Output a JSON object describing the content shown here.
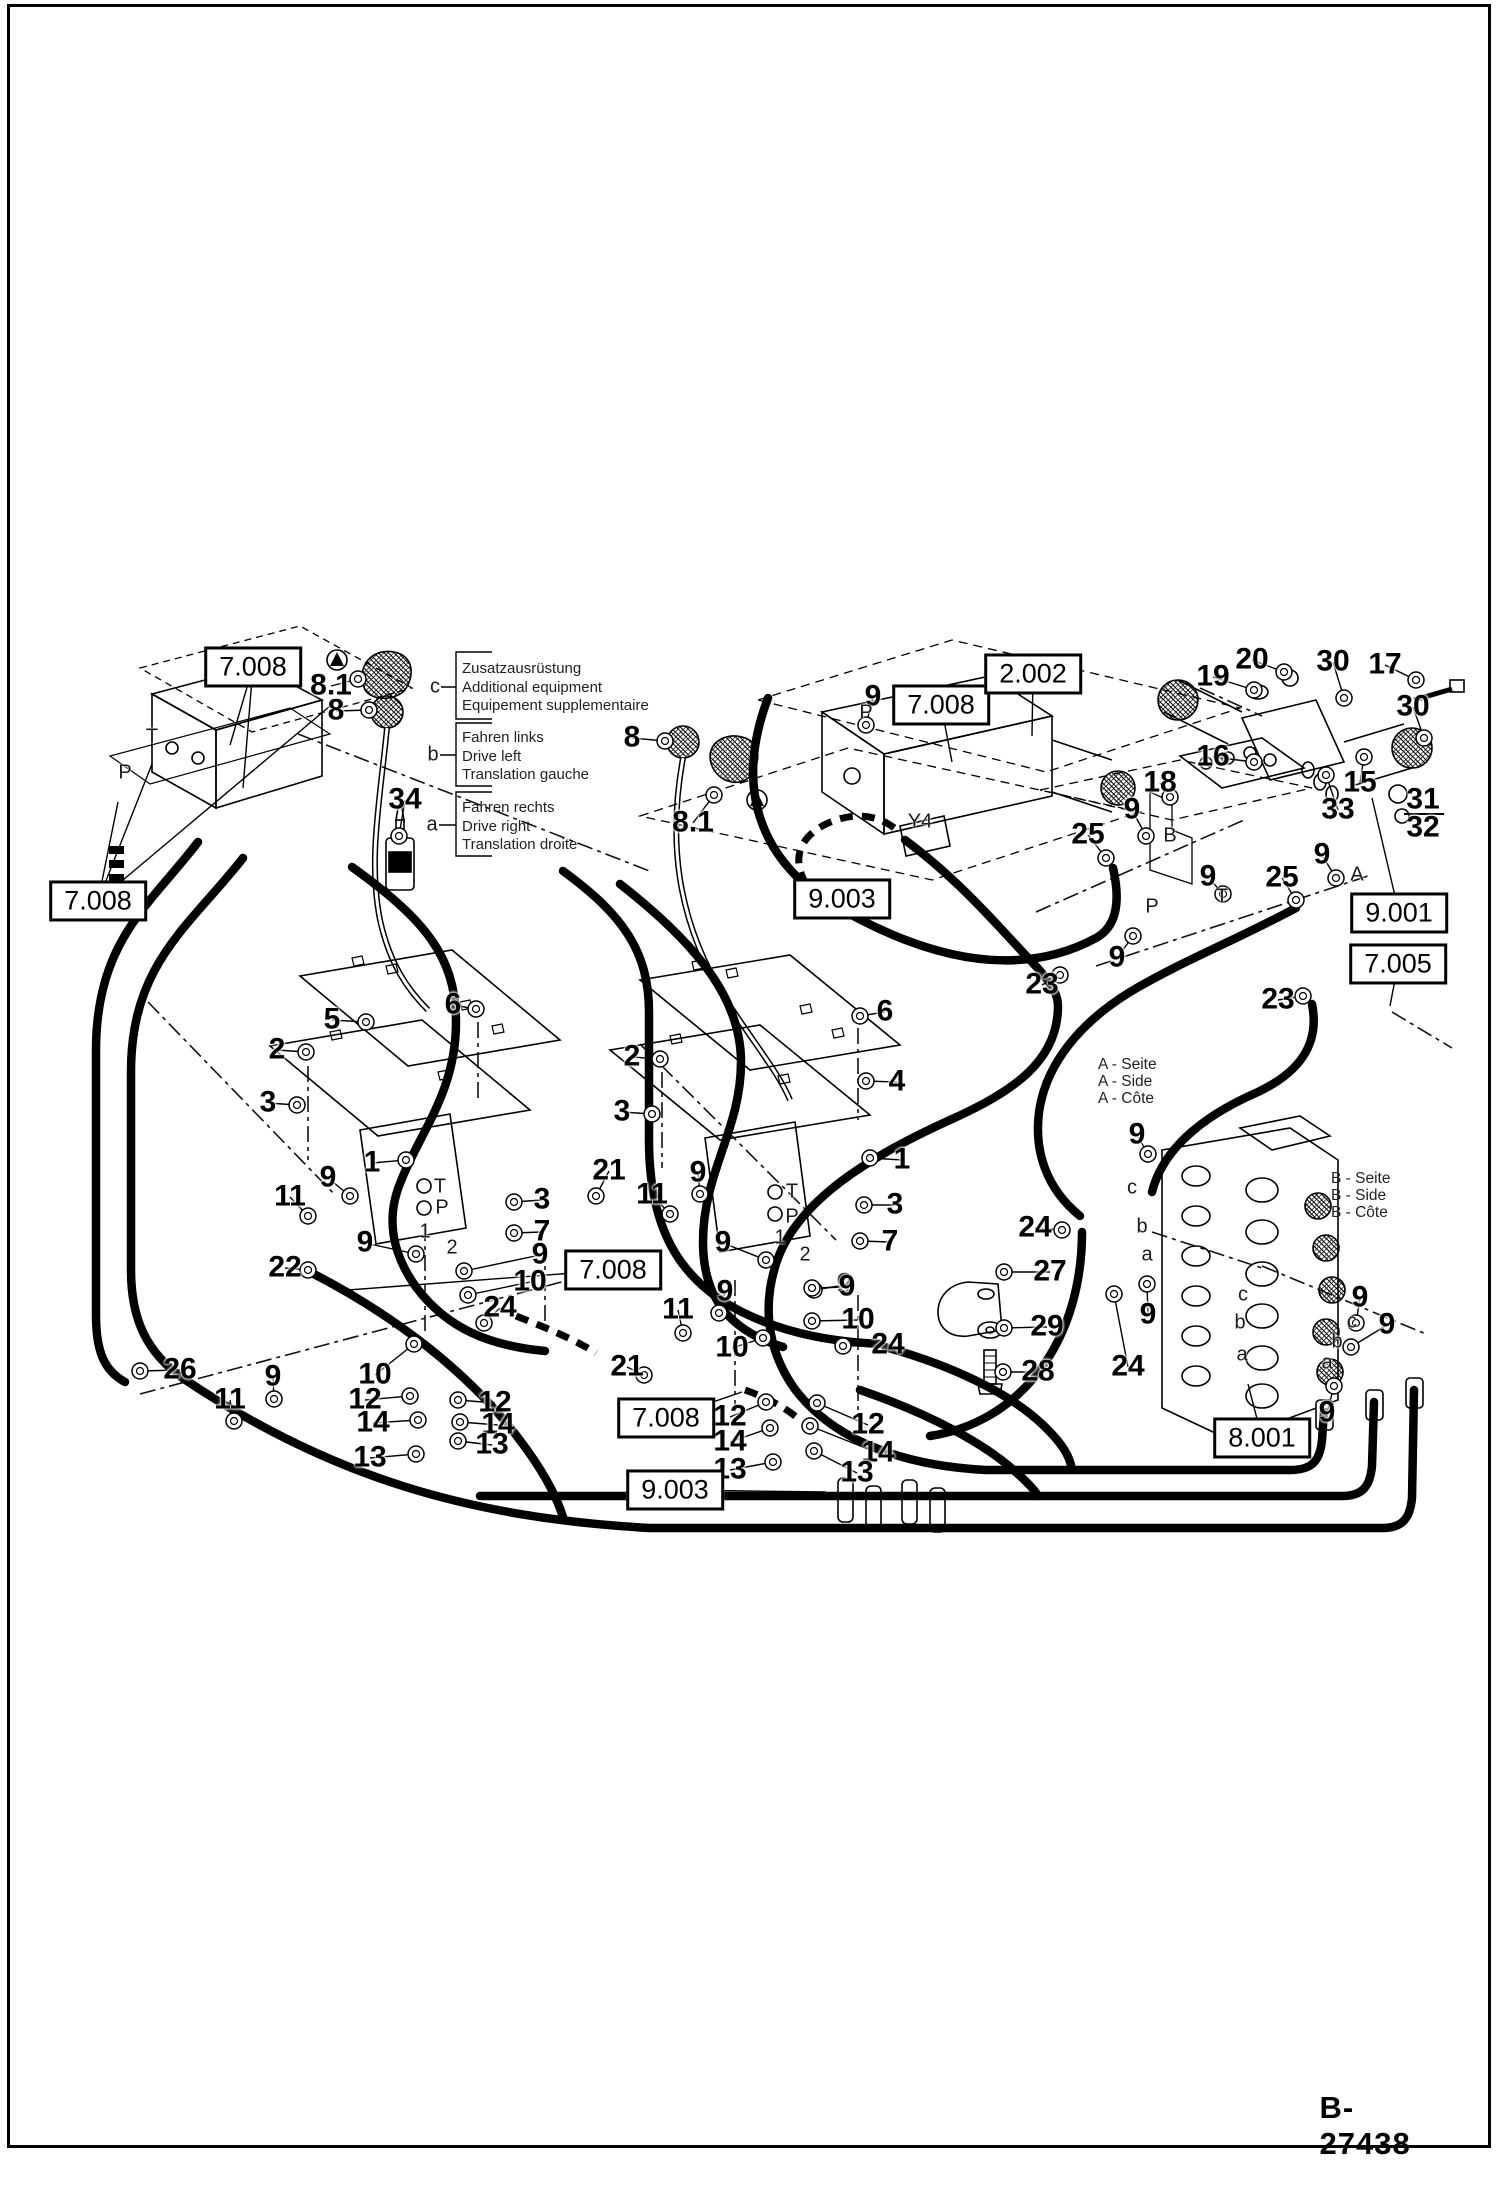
{
  "page": {
    "drawing_number": "B-27438"
  },
  "legend": {
    "groups": [
      {
        "letter": "c",
        "lines": [
          "Zusatzausrüstung",
          "Additional equipment",
          "Equipement supplementaire"
        ]
      },
      {
        "letter": "b",
        "lines": [
          "Fahren links",
          "Drive left",
          "Translation gauche"
        ]
      },
      {
        "letter": "a",
        "lines": [
          "Fahren rechts",
          "Drive right",
          "Translation droite"
        ]
      }
    ]
  },
  "side_notes": {
    "a_side": [
      "A - Seite",
      "A - Side",
      "A - Côte"
    ],
    "b_side": [
      "B - Seite",
      "B - Side",
      "B - Côte"
    ]
  },
  "diagram": {
    "ref_boxes": [
      {
        "text": "7.008",
        "x": 253,
        "y": 667,
        "leads": [
          [
            230,
            745
          ],
          [
            243,
            788
          ]
        ]
      },
      {
        "text": "7.008",
        "x": 98,
        "y": 901,
        "leads": [
          [
            118,
            802
          ],
          [
            152,
            764
          ],
          [
            330,
            706
          ]
        ]
      },
      {
        "text": "7.008",
        "x": 941,
        "y": 705,
        "leads": [
          [
            952,
            762
          ]
        ]
      },
      {
        "text": "2.002",
        "x": 1033,
        "y": 674,
        "leads": [
          [
            1032,
            736
          ]
        ]
      },
      {
        "text": "9.003",
        "x": 842,
        "y": 899,
        "leads": []
      },
      {
        "text": "9.001",
        "x": 1399,
        "y": 913,
        "leads": [
          [
            1372,
            798
          ]
        ]
      },
      {
        "text": "7.005",
        "x": 1398,
        "y": 964,
        "leads": [
          [
            1390,
            1006
          ]
        ]
      },
      {
        "text": "8.001",
        "x": 1262,
        "y": 1438,
        "leads": [
          [
            1248,
            1384
          ]
        ]
      },
      {
        "text": "7.008",
        "x": 613,
        "y": 1270,
        "leads": [
          [
            348,
            1290
          ]
        ]
      },
      {
        "text": "7.008",
        "x": 666,
        "y": 1418,
        "leads": [
          [
            742,
            1392
          ]
        ]
      },
      {
        "text": "9.003",
        "x": 675,
        "y": 1490,
        "leads": [
          [
            826,
            1492
          ]
        ]
      }
    ],
    "part_labels": [
      {
        "t": "8.1",
        "x": 331,
        "y": 686,
        "l": [
          358,
          679
        ]
      },
      {
        "t": "8",
        "x": 336,
        "y": 711,
        "l": [
          369,
          710
        ]
      },
      {
        "t": "34",
        "x": 405,
        "y": 800,
        "l": [
          399,
          836
        ]
      },
      {
        "t": "8",
        "x": 632,
        "y": 738,
        "l": [
          665,
          741
        ]
      },
      {
        "t": "8.1",
        "x": 693,
        "y": 823,
        "l": [
          714,
          795
        ]
      },
      {
        "t": "9",
        "x": 873,
        "y": 697,
        "l": [
          866,
          725
        ]
      },
      {
        "t": "25",
        "x": 1088,
        "y": 835,
        "l": [
          1106,
          858
        ]
      },
      {
        "t": "9",
        "x": 1132,
        "y": 810,
        "l": [
          1146,
          836
        ]
      },
      {
        "t": "23",
        "x": 1042,
        "y": 985,
        "l": [
          1060,
          975
        ]
      },
      {
        "t": "9",
        "x": 1117,
        "y": 958,
        "l": [
          1133,
          936
        ]
      },
      {
        "t": "25",
        "x": 1282,
        "y": 878,
        "l": [
          1296,
          900
        ]
      },
      {
        "t": "9",
        "x": 1322,
        "y": 855,
        "l": [
          1336,
          878
        ]
      },
      {
        "t": "23",
        "x": 1278,
        "y": 1000,
        "l": [
          1303,
          996
        ]
      },
      {
        "t": "19",
        "x": 1213,
        "y": 677,
        "l": [
          1254,
          690
        ]
      },
      {
        "t": "20",
        "x": 1252,
        "y": 660,
        "l": [
          1284,
          672
        ]
      },
      {
        "t": "30",
        "x": 1333,
        "y": 662,
        "l": [
          1344,
          698
        ]
      },
      {
        "t": "17",
        "x": 1385,
        "y": 665,
        "l": [
          1416,
          680
        ]
      },
      {
        "t": "30",
        "x": 1413,
        "y": 707,
        "l": [
          1424,
          738
        ]
      },
      {
        "t": "16",
        "x": 1213,
        "y": 757,
        "l": [
          1254,
          762
        ]
      },
      {
        "t": "15",
        "x": 1360,
        "y": 783,
        "l": [
          1364,
          757
        ]
      },
      {
        "t": "33",
        "x": 1338,
        "y": 810,
        "l": [
          1326,
          775
        ]
      },
      {
        "t": "18",
        "x": 1160,
        "y": 783,
        "l": [
          1170,
          797
        ]
      },
      {
        "t": "31",
        "x": 1423,
        "y": 800
      },
      {
        "t": "32",
        "x": 1423,
        "y": 828
      },
      {
        "t": "5",
        "x": 332,
        "y": 1020,
        "l": [
          366,
          1022
        ]
      },
      {
        "t": "6",
        "x": 453,
        "y": 1005,
        "l": [
          476,
          1009
        ]
      },
      {
        "t": "2",
        "x": 277,
        "y": 1050,
        "l": [
          306,
          1052
        ]
      },
      {
        "t": "3",
        "x": 268,
        "y": 1103,
        "l": [
          297,
          1105
        ]
      },
      {
        "t": "1",
        "x": 372,
        "y": 1163,
        "l": [
          406,
          1160
        ]
      },
      {
        "t": "9",
        "x": 328,
        "y": 1178,
        "l": [
          350,
          1196
        ]
      },
      {
        "t": "11",
        "x": 290,
        "y": 1197,
        "l": [
          308,
          1216
        ]
      },
      {
        "t": "3",
        "x": 542,
        "y": 1200,
        "l": [
          514,
          1202
        ]
      },
      {
        "t": "7",
        "x": 542,
        "y": 1232,
        "l": [
          514,
          1233
        ]
      },
      {
        "t": "21",
        "x": 609,
        "y": 1171,
        "l": [
          596,
          1196
        ]
      },
      {
        "t": "2",
        "x": 632,
        "y": 1057,
        "l": [
          660,
          1059
        ]
      },
      {
        "t": "3",
        "x": 622,
        "y": 1112,
        "l": [
          652,
          1114
        ]
      },
      {
        "t": "6",
        "x": 885,
        "y": 1012,
        "l": [
          860,
          1016
        ]
      },
      {
        "t": "4",
        "x": 897,
        "y": 1082,
        "l": [
          866,
          1081
        ]
      },
      {
        "t": "1",
        "x": 902,
        "y": 1160,
        "l": [
          870,
          1158
        ]
      },
      {
        "t": "3",
        "x": 895,
        "y": 1205,
        "l": [
          864,
          1205
        ]
      },
      {
        "t": "7",
        "x": 890,
        "y": 1242,
        "l": [
          860,
          1241
        ]
      },
      {
        "t": "11",
        "x": 652,
        "y": 1195,
        "l": [
          670,
          1214
        ]
      },
      {
        "t": "9",
        "x": 698,
        "y": 1173,
        "l": [
          700,
          1194
        ]
      },
      {
        "t": "9",
        "x": 723,
        "y": 1243,
        "l": [
          766,
          1260
        ]
      },
      {
        "t": "9",
        "x": 845,
        "y": 1285,
        "l": [
          814,
          1290
        ]
      },
      {
        "t": "22",
        "x": 285,
        "y": 1268,
        "l": [
          308,
          1270
        ]
      },
      {
        "t": "9",
        "x": 365,
        "y": 1243,
        "l": [
          416,
          1254
        ]
      },
      {
        "t": "9",
        "x": 540,
        "y": 1255,
        "l": [
          464,
          1271
        ]
      },
      {
        "t": "10",
        "x": 530,
        "y": 1282,
        "l": [
          468,
          1295
        ]
      },
      {
        "t": "24",
        "x": 500,
        "y": 1308,
        "l": [
          484,
          1323
        ]
      },
      {
        "t": "10",
        "x": 375,
        "y": 1375,
        "l": [
          414,
          1344
        ]
      },
      {
        "t": "12",
        "x": 365,
        "y": 1400,
        "l": [
          410,
          1396
        ]
      },
      {
        "t": "14",
        "x": 373,
        "y": 1423,
        "l": [
          418,
          1420
        ]
      },
      {
        "t": "13",
        "x": 370,
        "y": 1458,
        "l": [
          416,
          1454
        ]
      },
      {
        "t": "12",
        "x": 495,
        "y": 1403,
        "l": [
          458,
          1400
        ]
      },
      {
        "t": "14",
        "x": 498,
        "y": 1425,
        "l": [
          460,
          1422
        ]
      },
      {
        "t": "13",
        "x": 492,
        "y": 1445,
        "l": [
          458,
          1441
        ]
      },
      {
        "t": "9",
        "x": 273,
        "y": 1377,
        "l": [
          274,
          1399
        ]
      },
      {
        "t": "26",
        "x": 180,
        "y": 1370,
        "l": [
          140,
          1371
        ]
      },
      {
        "t": "11",
        "x": 230,
        "y": 1400,
        "l": [
          234,
          1421
        ]
      },
      {
        "t": "11",
        "x": 678,
        "y": 1310,
        "l": [
          683,
          1333
        ]
      },
      {
        "t": "9",
        "x": 725,
        "y": 1292,
        "l": [
          719,
          1313
        ]
      },
      {
        "t": "9",
        "x": 847,
        "y": 1287,
        "l": [
          812,
          1288
        ]
      },
      {
        "t": "10",
        "x": 858,
        "y": 1320,
        "l": [
          812,
          1321
        ]
      },
      {
        "t": "24",
        "x": 888,
        "y": 1345,
        "l": [
          843,
          1346
        ]
      },
      {
        "t": "21",
        "x": 627,
        "y": 1367,
        "l": [
          644,
          1375
        ]
      },
      {
        "t": "10",
        "x": 732,
        "y": 1348,
        "l": [
          763,
          1338
        ]
      },
      {
        "t": "12",
        "x": 730,
        "y": 1417,
        "l": [
          766,
          1402
        ]
      },
      {
        "t": "14",
        "x": 730,
        "y": 1442,
        "l": [
          770,
          1428
        ]
      },
      {
        "t": "13",
        "x": 730,
        "y": 1470,
        "l": [
          773,
          1462
        ]
      },
      {
        "t": "12",
        "x": 868,
        "y": 1425,
        "l": [
          817,
          1403
        ]
      },
      {
        "t": "14",
        "x": 878,
        "y": 1453,
        "l": [
          810,
          1426
        ]
      },
      {
        "t": "13",
        "x": 857,
        "y": 1473,
        "l": [
          814,
          1451
        ]
      },
      {
        "t": "24",
        "x": 1035,
        "y": 1228,
        "l": [
          1062,
          1230
        ]
      },
      {
        "t": "27",
        "x": 1050,
        "y": 1272,
        "l": [
          1004,
          1272
        ]
      },
      {
        "t": "29",
        "x": 1047,
        "y": 1327,
        "l": [
          1004,
          1328
        ]
      },
      {
        "t": "28",
        "x": 1038,
        "y": 1372,
        "l": [
          1003,
          1372
        ]
      },
      {
        "t": "9",
        "x": 1148,
        "y": 1315,
        "l": [
          1147,
          1284
        ]
      },
      {
        "t": "24",
        "x": 1128,
        "y": 1367,
        "l": [
          1114,
          1294
        ]
      },
      {
        "t": "9",
        "x": 1360,
        "y": 1298,
        "l": [
          1356,
          1323
        ]
      },
      {
        "t": "9",
        "x": 1387,
        "y": 1325,
        "l": [
          1351,
          1347
        ]
      },
      {
        "t": "9",
        "x": 1327,
        "y": 1413,
        "l": [
          1334,
          1386
        ]
      },
      {
        "t": "9",
        "x": 1137,
        "y": 1135,
        "l": [
          1148,
          1154
        ]
      },
      {
        "t": "9",
        "x": 1208,
        "y": 877,
        "l": [
          1223,
          894
        ]
      }
    ],
    "letters": [
      {
        "t": "T",
        "x": 152,
        "y": 737
      },
      {
        "t": "P",
        "x": 125,
        "y": 773
      },
      {
        "t": "P",
        "x": 866,
        "y": 713
      },
      {
        "t": "Y4",
        "x": 920,
        "y": 822
      },
      {
        "t": "T",
        "x": 440,
        "y": 1187
      },
      {
        "t": "P",
        "x": 442,
        "y": 1208
      },
      {
        "t": "T",
        "x": 792,
        "y": 1192
      },
      {
        "t": "P",
        "x": 792,
        "y": 1217
      },
      {
        "t": "B",
        "x": 1170,
        "y": 836
      },
      {
        "t": "A",
        "x": 1357,
        "y": 875
      },
      {
        "t": "P",
        "x": 1152,
        "y": 907
      },
      {
        "t": "T",
        "x": 1222,
        "y": 897
      },
      {
        "t": "b",
        "x": 1142,
        "y": 1227
      },
      {
        "t": "a",
        "x": 1147,
        "y": 1255
      },
      {
        "t": "c",
        "x": 1352,
        "y": 1322
      },
      {
        "t": "b",
        "x": 1337,
        "y": 1342
      },
      {
        "t": "a",
        "x": 1327,
        "y": 1363
      },
      {
        "t": "c",
        "x": 1243,
        "y": 1295
      },
      {
        "t": "b",
        "x": 1240,
        "y": 1323
      },
      {
        "t": "a",
        "x": 1242,
        "y": 1355
      },
      {
        "t": "c",
        "x": 1132,
        "y": 1188
      },
      {
        "t": "1",
        "x": 425,
        "y": 1232,
        "s": 1
      },
      {
        "t": "2",
        "x": 452,
        "y": 1248,
        "s": 1
      },
      {
        "t": "1",
        "x": 780,
        "y": 1238,
        "s": 1
      },
      {
        "t": "2",
        "x": 805,
        "y": 1255,
        "s": 1
      }
    ],
    "hoses": [
      "M198,842 C150,905 97,940 96,1048 L96,1315 C96,1353 105,1371 125,1382",
      "M243,858 C190,926 131,963 131,1072 L131,1270 C131,1320 147,1353 184,1379 C330,1477 470,1518 650,1528 L1382,1528 C1402,1528 1410,1519 1412,1498 L1414,1390",
      "M310,1272 C392,1314 468,1371 519,1439 C545,1473 557,1498 563,1517",
      "M352,867 C424,919 456,956 456,1022 C456,1092 420,1132 401,1181 C386,1216 391,1252 416,1287 C448,1330 492,1346 545,1351",
      "M563,871 C622,914 649,951 649,1012 L649,1140 C649,1232 682,1282 742,1312 C790,1336 840,1342 880,1344",
      "M620,884 C702,948 741,1002 741,1062 C741,1130 703,1172 703,1242 C703,1302 734,1332 783,1347",
      "M768,698 C734,788 760,858 830,903 C932,963 1022,978 1096,938 C1116,927 1121,903 1113,868",
      "M905,840 C962,882 1003,932 1032,962 C1050,981 1058,993 1058,1006 C1058,1062 1012,1092 950,1120 C868,1157 800,1200 778,1258 C762,1302 766,1348 794,1388 C834,1442 906,1466 986,1470 L1290,1470 C1312,1470 1320,1461 1322,1440 L1324,1412",
      "M1296,908 C1232,942 1180,962 1130,992 C1078,1024 1048,1064 1040,1106 C1032,1152 1048,1190 1080,1216",
      "M1312,1004 C1320,1044 1300,1072 1258,1092 C1198,1118 1162,1152 1152,1192",
      "M480,1496 L1342,1496 C1362,1496 1370,1487 1372,1466 L1374,1402",
      "M1082,1232 C1082,1280 1070,1330 1040,1370 C1010,1410 970,1430 930,1436",
      "M885,1347 C950,1365 1008,1392 1042,1424 C1062,1443 1070,1456 1072,1470",
      "M860,1390 C930,1414 986,1444 1018,1474 C1030,1485 1036,1492 1038,1496"
    ],
    "dashed_hoses": [
      "M806,884 C792,860 798,838 826,824 C856,810 880,816 897,830",
      "M516,1316 C552,1330 577,1341 596,1353",
      "M745,1390 C768,1398 786,1408 800,1420"
    ],
    "dashdot": [
      "M298,734 L652,872",
      "M148,1002 L336,1196",
      "M640,1044 L836,1240",
      "M140,1394 L614,1268",
      "M425,1225 L425,1335",
      "M545,1245 L545,1335",
      "M735,1280 L735,1405",
      "M858,1295 L858,1415",
      "M308,1066 L308,1160",
      "M478,1022 L478,1102",
      "M662,1072 L662,1168",
      "M858,1028 L858,1120",
      "M1036,912 L1244,820",
      "M1096,966 L1368,876",
      "M1262,1266 L1426,1334",
      "M1152,1232 L1262,1268",
      "M1392,1012 L1452,1048",
      "M1200,688 L1262,716"
    ]
  }
}
